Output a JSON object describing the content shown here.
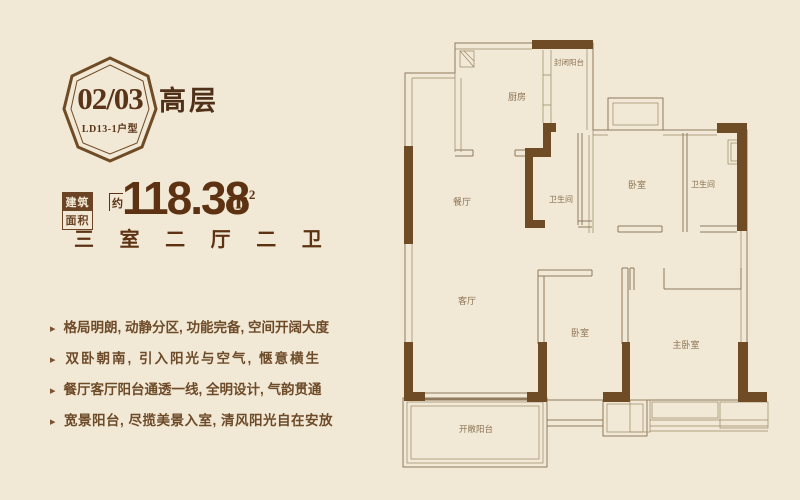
{
  "badge": {
    "number": "02/03",
    "model": "LD13-1户型"
  },
  "floor_type": "高层",
  "area": {
    "label_top": "建筑",
    "label_bottom": "面积",
    "approx": "约",
    "value": "118.38",
    "unit_base": "m",
    "unit_exp": "2"
  },
  "layout_summary": "三 室 二 厅 二 卫",
  "bullet": "▸",
  "features": [
    "格局明朗, 动静分区, 功能完备, 空间开阔大度",
    "双卧朝南, 引入阳光与空气, 惬意横生",
    "餐厅客厅阳台通透一线, 全明设计, 气韵贯通",
    "宽景阳台, 尽揽美景入室, 清风阳光自在安放"
  ],
  "floorplan": {
    "rooms": [
      {
        "label": "封闭阳台"
      },
      {
        "label": "厨房"
      },
      {
        "label": "餐厅"
      },
      {
        "label": "卫生间"
      },
      {
        "label": "卧室"
      },
      {
        "label": "卫生间"
      },
      {
        "label": "客厅"
      },
      {
        "label": "卧室"
      },
      {
        "label": "主卧室"
      },
      {
        "label": "开敞阳台"
      }
    ]
  },
  "colors": {
    "background": "#f1e8d5",
    "plan_fill": "#f6efe0",
    "wall_thick": "#6f4b26",
    "wall_thin": "#8e7b5f",
    "text_dark": "#5c3213",
    "text_medium": "#6d4b29",
    "label_brown": "#8a7252"
  }
}
